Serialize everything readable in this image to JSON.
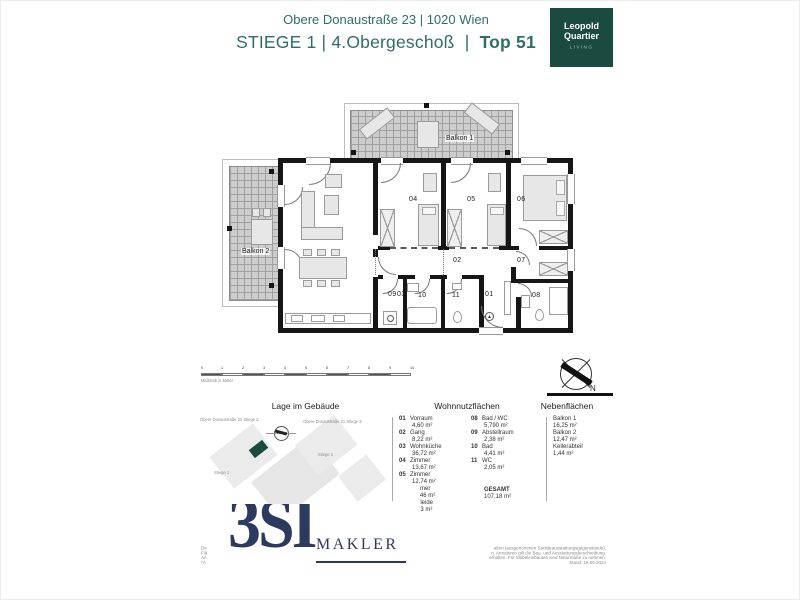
{
  "header": {
    "address": "Obere Donaustraße 23 | 1020 Wien",
    "title_main": "STIEGE 1 | 4.Obergeschoß",
    "title_sep": "|",
    "title_unit": "Top 51"
  },
  "brand_logo": {
    "line1": "Leopold",
    "line2": "Quartier",
    "line3": "LIVING"
  },
  "floorplan": {
    "labels": {
      "r01": "01",
      "r02": "02",
      "r03": "03",
      "r04": "04",
      "r05": "05",
      "r06": "06",
      "r07": "07",
      "r08": "08",
      "r09": "09",
      "r10": "10",
      "r11": "11",
      "balkon1": "Balkon 1",
      "balkon2": "Balkon 2"
    }
  },
  "scalebar": {
    "label": "Maßstab in Meter",
    "ticks": [
      "0",
      "1",
      "2",
      "3",
      "4",
      "5",
      "6",
      "7",
      "8",
      "9",
      "10"
    ]
  },
  "compass": {
    "north": "N"
  },
  "location": {
    "heading": "Lage im Gebäude",
    "label_top_left": "Obere Donaustraße 23 Stiege 2",
    "label_top_right": "Obere Donaustraße 21 Stiege 3",
    "label_mid": "Stiege 1",
    "label_bottom": "Stiege 1"
  },
  "living_areas": {
    "heading": "Wohnnutzflächen",
    "items": [
      {
        "no": "01",
        "name": "Vorraum",
        "value": "4,60 m²"
      },
      {
        "no": "02",
        "name": "Gang",
        "value": "8,22 m²"
      },
      {
        "no": "03",
        "name": "Wohnküche",
        "value": "36,72 m²"
      },
      {
        "no": "04",
        "name": "Zimmer",
        "value": "13,67 m²"
      },
      {
        "no": "05",
        "name": "Zimmer",
        "value": "12,74 m²"
      },
      {
        "no": "06",
        "name": "Zimmer",
        "value": "11,46 m²"
      },
      {
        "no": "07",
        "name": "Ankleide",
        "value": "5,13 m²"
      },
      {
        "no": "08",
        "name": "Bad / WC",
        "value": "5,790 m²"
      },
      {
        "no": "09",
        "name": "Abstellraum",
        "value": "2,38 m²"
      },
      {
        "no": "10",
        "name": "Bad",
        "value": "4,41 m²"
      },
      {
        "no": "11",
        "name": "WC",
        "value": "2,05 m²"
      }
    ],
    "total_label": "GESAMT",
    "total_value": "107,18 m²"
  },
  "side_areas": {
    "heading": "Nebenflächen",
    "items": [
      {
        "name": "Balkon 1",
        "value": "16,25 m²"
      },
      {
        "name": "Balkon 2",
        "value": "12,47 m²"
      },
      {
        "name": "Kellerabteil",
        "value": "1,44 m²"
      }
    ]
  },
  "broker": {
    "logo_big": "3SI",
    "logo_sub": "MAKLER"
  },
  "fineprint": {
    "left_lines": [
      "De",
      "Flä",
      "An",
      "*A"
    ],
    "right_lines": [
      "alten (ausgenommen Sanitärausstattungsgegenstände),",
      "n. Armaturen gilt die Bau- und Ausstattungsbeschreibung.",
      "erhalten. Für Möbeleinbauten sind Naturmaße zu nehmen.",
      "Stand: 16.05.2024"
    ]
  },
  "colors": {
    "teal": "#2F6F66",
    "logo_green": "#1B4B3E",
    "navy": "#2B3A5E"
  }
}
